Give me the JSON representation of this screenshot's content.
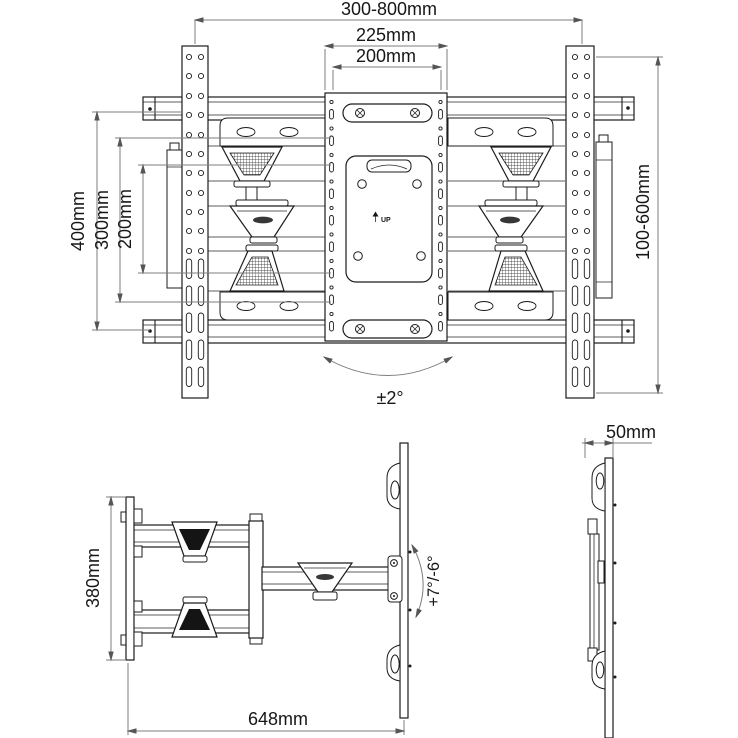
{
  "colors": {
    "line": "#1c1c1c",
    "dimension": "#7d7d7d",
    "background": "#ffffff",
    "joint_dark": "#141414"
  },
  "front_view": {
    "title": "wall mount front view",
    "dims": {
      "total_width": "300-800mm",
      "plate_width": "225mm",
      "vesa_width": "200mm",
      "height_outer": "400mm",
      "height_mid": "300mm",
      "height_inner": "200mm",
      "rail_height": "100-600mm",
      "swivel": "±2°"
    },
    "up_label": "UP"
  },
  "arm_view": {
    "title": "articulating arm top view",
    "dims": {
      "wall_plate_height": "380mm",
      "extension": "648mm",
      "tilt": "+7°/-6°"
    }
  },
  "profile_view": {
    "title": "folded side profile",
    "dims": {
      "folded_depth": "50mm"
    }
  }
}
